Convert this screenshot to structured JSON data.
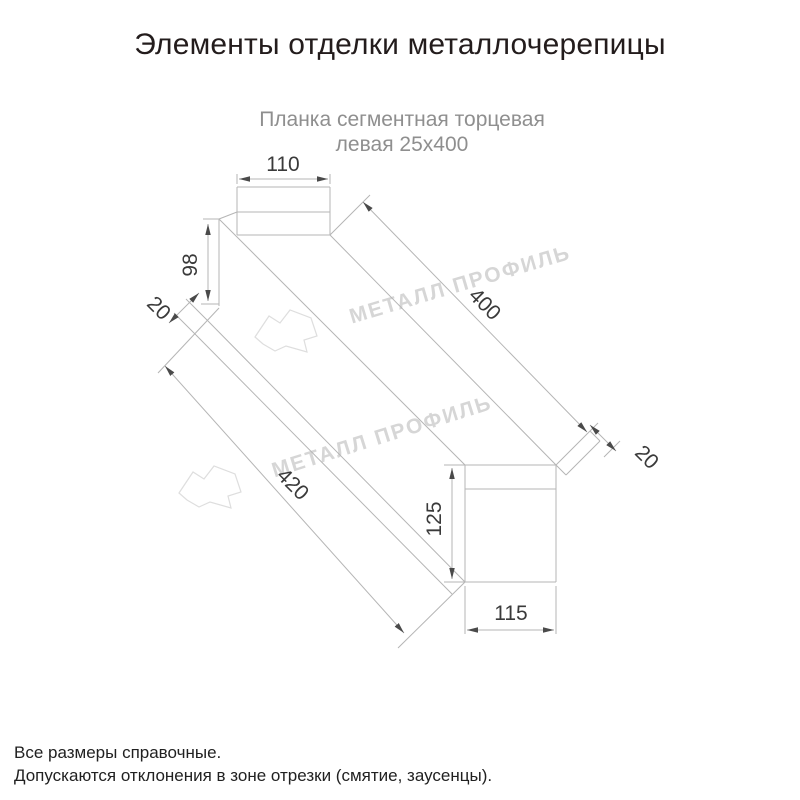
{
  "title": "Элементы отделки металлочерепицы",
  "subtitle": {
    "line1": "Планка сегментная торцевая",
    "line2": "левая 25х400"
  },
  "drawing": {
    "type": "isometric technical line drawing of metal roof end trim strip",
    "dims": {
      "top_flat_width": "110",
      "web_height": "98",
      "flange_width": "20",
      "length_top": "400",
      "end_fold": "20",
      "length_bottom": "420",
      "end_face_height": "125",
      "end_face_width": "115"
    }
  },
  "watermark": {
    "text": "МЕТАЛЛ ПРОФИЛЬ"
  },
  "notes": {
    "line1": "Все размеры справочные.",
    "line2": "Допускаются отклонения в зоне отрезки (смятие, заусенцы)."
  },
  "colors": {
    "background": "#ffffff",
    "title_text": "#231c1c",
    "subtitle_text": "#8f8f8f",
    "drawing_lines": "#b5b5b5",
    "dimension_text": "#3a3a3a",
    "arrowheads": "#4a4a4a",
    "watermark": "#d6d6d6",
    "notes_text": "#212121"
  }
}
